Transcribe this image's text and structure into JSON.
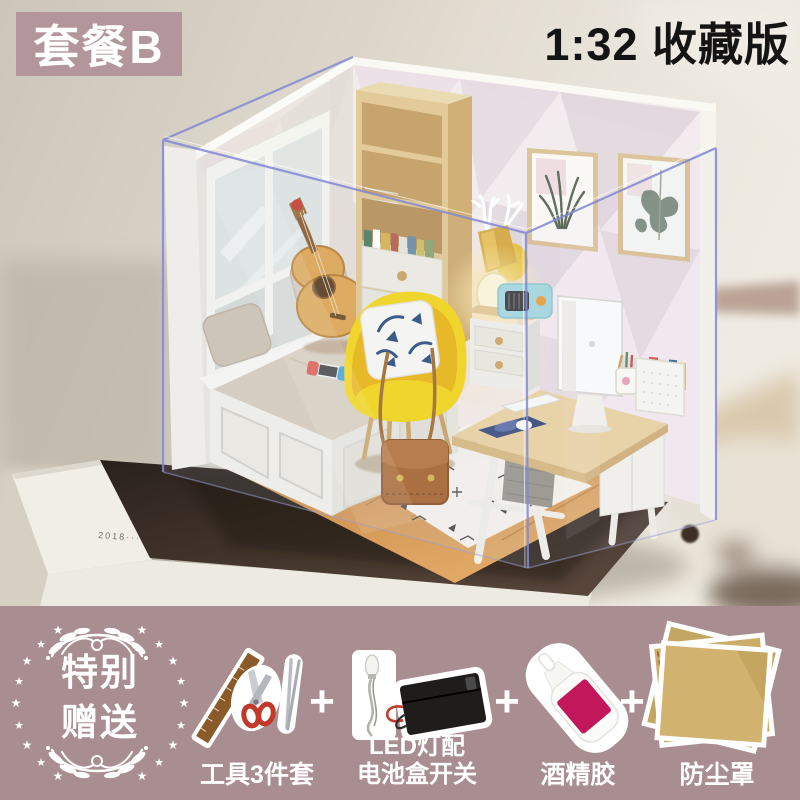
{
  "badge": {
    "text": "套餐B",
    "bg": "#b2969b",
    "color": "#ffffff"
  },
  "title": {
    "text": "1:32 收藏版",
    "color": "#141414"
  },
  "photo": {
    "base_label": "2018······",
    "scene_objects": [
      "acrylic-dust-cover",
      "display-base",
      "window",
      "window-seat",
      "pillows",
      "nintendo-switch",
      "guitar",
      "bookshelf",
      "wall-lamp",
      "picture-frame-snake-plant",
      "picture-frame-monstera",
      "yellow-armchair",
      "throw-pillow",
      "satchel-bag",
      "rug",
      "desk",
      "computer",
      "keyboard",
      "mouse-pad",
      "drawer-cabinet",
      "radio",
      "mug",
      "file-organizer",
      "storage-box"
    ],
    "colors": {
      "chair_yellow": "#f6d512",
      "wood": "#cf9050",
      "acrylic_edge": "#8288d4",
      "mat": "#3a2d25",
      "wallpaper": "#f4ebee"
    }
  },
  "footer": {
    "bg": "#a98e91",
    "gift_badge": {
      "line1": "特别",
      "line2": "赠送",
      "star": "★"
    },
    "plus": "+",
    "items": [
      {
        "id": "tools",
        "label": "工具3件套"
      },
      {
        "id": "led",
        "label_line1": "LED灯配",
        "label_line2": "电池盒开关"
      },
      {
        "id": "glue",
        "label": "酒精胶"
      },
      {
        "id": "cover",
        "label": "防尘罩"
      }
    ]
  }
}
